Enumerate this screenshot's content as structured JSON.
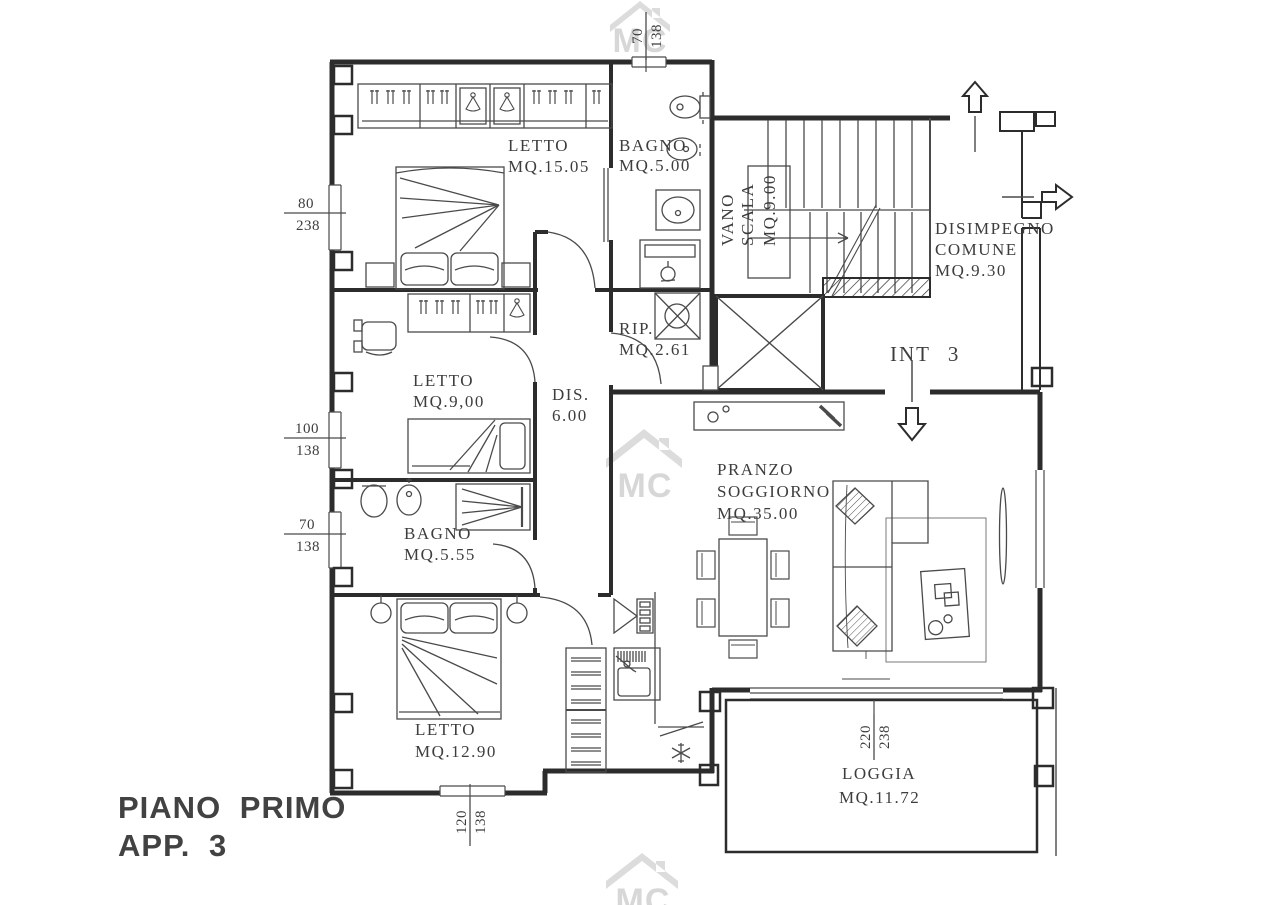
{
  "title": {
    "line1": "PIANO PRIMO",
    "line2": "APP. 3"
  },
  "watermark": {
    "text": "MC",
    "color": "#d7d7d7"
  },
  "unit_label": "INT 3",
  "rooms": {
    "letto1": {
      "name": "LETTO",
      "area": "MQ.15.05"
    },
    "bagno1": {
      "name": "BAGNO",
      "area": "MQ.5.00"
    },
    "vano_scala": {
      "line1": "VANO",
      "line2": "SCALA",
      "area": "MQ.9.00"
    },
    "disimpegno": {
      "line1": "DISIMPEGNO",
      "line2": "COMUNE",
      "area": "MQ.9.30"
    },
    "rip": {
      "name": "RIP.",
      "area": "MQ.2.61"
    },
    "dis": {
      "name": "DIS.",
      "area": "6.00"
    },
    "letto2": {
      "name": "LETTO",
      "area": "MQ.9,00"
    },
    "bagno2": {
      "name": "BAGNO",
      "area": "MQ.5.55"
    },
    "letto3": {
      "name": "LETTO",
      "area": "MQ.12.90"
    },
    "pranzo": {
      "line1": "PRANZO",
      "line2": "SOGGIORNO",
      "area": "MQ.35.00"
    },
    "loggia": {
      "name": "LOGGIA",
      "area": "MQ.11.72"
    }
  },
  "dimensions": {
    "top": {
      "num": "70",
      "den": "138"
    },
    "left_upper": {
      "num": "80",
      "den": "238"
    },
    "left_mid": {
      "num": "100",
      "den": "138"
    },
    "left_lower": {
      "num": "70",
      "den": "138"
    },
    "bottom": {
      "num": "120",
      "den": "138"
    },
    "loggia": {
      "num": "220",
      "den": "238"
    }
  },
  "colors": {
    "line": "#2c2c2c",
    "background": "#ffffff",
    "watermark": "#d7d7d7"
  }
}
